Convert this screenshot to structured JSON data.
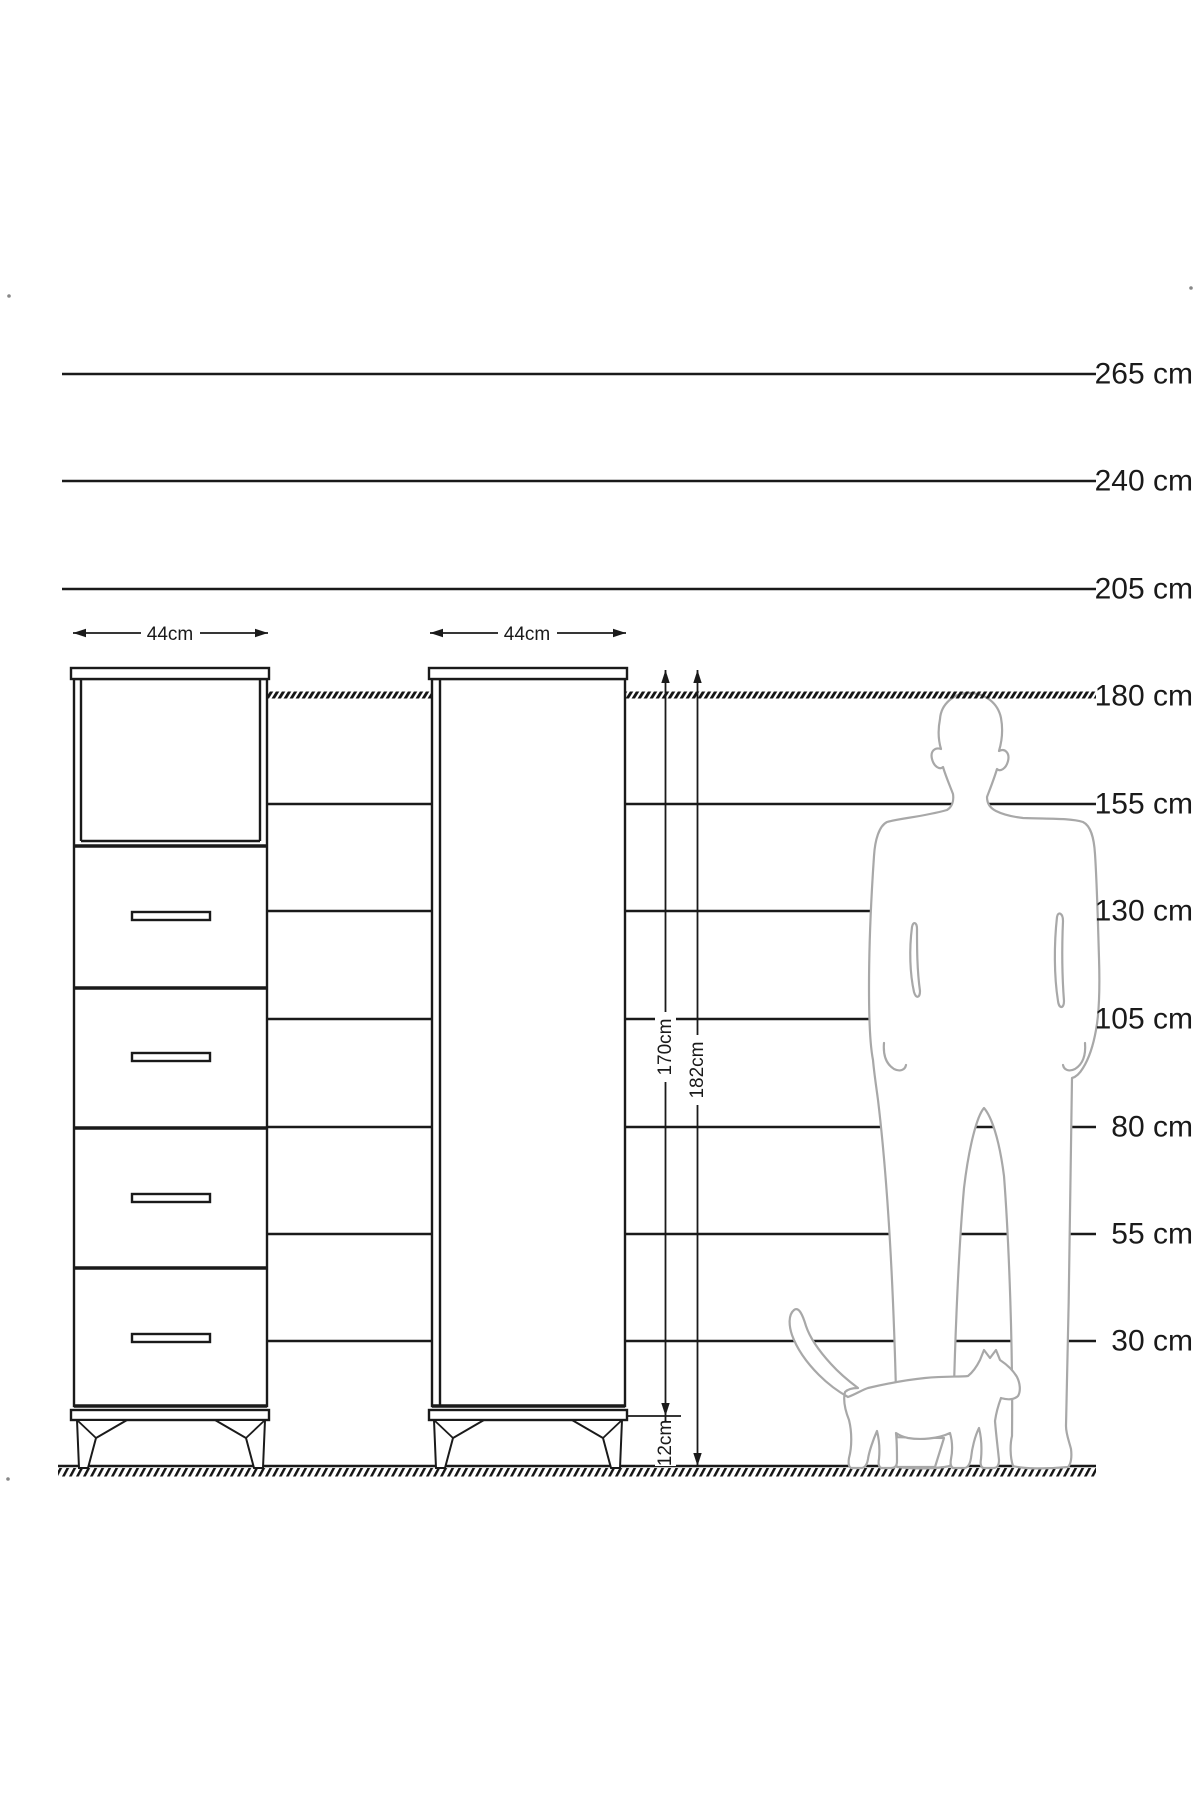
{
  "title": "Cabinet height comparison technical drawing",
  "scale": {
    "labels": [
      "265 cm",
      "240 cm",
      "205 cm",
      "180 cm",
      "155 cm",
      "130 cm",
      "105 cm",
      "80 cm",
      "55 cm",
      "30 cm"
    ]
  },
  "cabinets": {
    "front_view": {
      "width_label": "44cm",
      "drawer_count": 4
    },
    "side_view": {
      "width_label": "44cm"
    }
  },
  "dimensions": {
    "body_height": "170cm",
    "total_height": "182cm",
    "leg_height": "12cm"
  },
  "colors": {
    "line": "#1a1a1a",
    "silhouette": "#a8a8a8",
    "background": "#ffffff"
  }
}
